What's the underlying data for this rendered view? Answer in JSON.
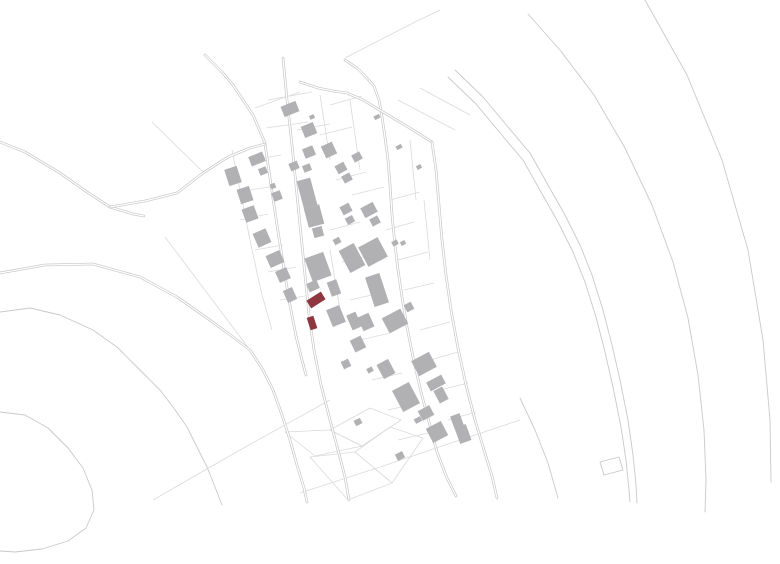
{
  "map": {
    "width": 780,
    "height": 564,
    "background": "#ffffff",
    "colors": {
      "building": "#b1b1b3",
      "building_dark": "#a4a4a6",
      "highlight": "#8e3741",
      "line": "#c9c9cc",
      "line_faint": "#dadadd",
      "road_casing": "#c3c3c6",
      "road_inner": "#ffffff"
    },
    "roads": [
      {
        "name": "north-approach",
        "points": "205,55 222,72 233,85 243,100 253,115 259,129 265,143"
      },
      {
        "name": "main-street",
        "points": "283,58 287,100 292,145 296,185 300,225 303,255 306,285 309,315 314,350 321,385 330,420 338,450 345,477 349,500"
      },
      {
        "name": "west-street",
        "points": "265,144 271,185 277,225 283,263 289,300 296,336 302,360 306,375"
      },
      {
        "name": "east-street",
        "points": "345,60 357,68 366,77 374,86 379,100 382,117 385,137 388,160 390,185 392,215 395,245 398,270 402,297 407,327 413,357 421,392 429,422 437,452 447,478 456,496"
      },
      {
        "name": "northeast-road",
        "points": "300,82 318,88 333,91 347,93 363,100 378,109 393,118 413,130 432,142"
      },
      {
        "name": "east-bypass",
        "points": "432,142 436,170 439,205 442,240 446,275 451,310 458,348 466,385 475,420 484,450 492,476 497,498"
      },
      {
        "name": "rural-southwest-road",
        "points": "0,273 45,265 93,264 140,277 177,297 207,318 233,337 250,350 263,370 273,390 282,415 290,440 297,465 304,488 307,502"
      },
      {
        "name": "west-lane-a",
        "points": "0,142 25,152 60,173 87,192 110,207 133,214 144,216"
      },
      {
        "name": "west-lane-b",
        "points": "110,207 145,201 177,193 203,173 228,157 250,148 265,144"
      }
    ],
    "paths": [
      {
        "name": "contour-lane-2",
        "points": "0,312 30,308 60,315 93,330 117,347 140,370 160,390 173,407 187,427 197,447 207,467 215,487 222,505"
      },
      {
        "name": "contour-hook",
        "points": "0,412 25,415 48,428 68,448 83,468 92,490 94,510 86,528 68,541 42,549 15,552 0,551"
      },
      {
        "name": "valley-curve-a",
        "points": "455,70 483,97 508,127 530,153 548,185 565,215 580,245 592,275 603,310 612,345 620,380 628,420 633,455 636,485 637,503"
      },
      {
        "name": "valley-curve-b",
        "points": "448,77 476,104 501,134 523,160 541,192 558,222 573,252 585,282 596,317 605,352 613,387 621,427 626,460 629,490 630,502"
      },
      {
        "name": "valley-curve-outer",
        "points": "528,14 560,50 594,95 625,148 652,205 673,262 688,318 698,375 704,430 706,480 705,512"
      },
      {
        "name": "valley-curve-far",
        "points": "645,0 687,75 722,160 748,250 763,340 770,420 771,482"
      },
      {
        "name": "south-fragment",
        "points": "520,398 535,430 548,463 558,498"
      }
    ],
    "faint_lines": [
      {
        "points": "165,237 250,350"
      },
      {
        "points": "152,122 203,172"
      },
      {
        "points": "153,500 240,450 330,400"
      },
      {
        "points": "300,493 380,467 460,440 520,420"
      },
      {
        "points": "345,58 380,40 415,22 440,10"
      },
      {
        "points": "398,100 455,130"
      },
      {
        "points": "420,88 470,115"
      },
      {
        "points": "255,108 277,100 300,92"
      },
      {
        "points": "232,150 242,200 252,250 262,295 272,330"
      },
      {
        "points": "268,100 312,92"
      },
      {
        "points": "266,128 308,122"
      },
      {
        "points": "252,160 281,155"
      },
      {
        "points": "297,130 330,124"
      },
      {
        "points": "250,190 276,186"
      },
      {
        "points": "240,220 268,214"
      },
      {
        "points": "255,250 283,245"
      },
      {
        "points": "268,272 296,267"
      },
      {
        "points": "280,300 305,296"
      },
      {
        "points": "330,105 362,96"
      },
      {
        "points": "320,135 352,127"
      },
      {
        "points": "336,180 366,172"
      },
      {
        "points": "352,195 384,187"
      },
      {
        "points": "330,230 360,222"
      },
      {
        "points": "342,262 372,255"
      },
      {
        "points": "390,200 420,192"
      },
      {
        "points": "386,230 414,222"
      },
      {
        "points": "398,260 428,252"
      },
      {
        "points": "404,290 434,283"
      },
      {
        "points": "350,300 380,293"
      },
      {
        "points": "360,340 390,333"
      },
      {
        "points": "372,380 402,373"
      },
      {
        "points": "388,410 418,403"
      },
      {
        "points": "398,440 428,433"
      },
      {
        "points": "420,330 450,322"
      },
      {
        "points": "430,360 458,352"
      },
      {
        "points": "440,390 468,383"
      },
      {
        "points": "448,420 476,412"
      },
      {
        "points": "320,95 330,160"
      },
      {
        "points": "350,100 360,170"
      },
      {
        "points": "410,140 416,200"
      },
      {
        "points": "424,200 430,260"
      },
      {
        "points": "330,250 340,310"
      }
    ],
    "parcel_polygons": [
      {
        "points": "355,452 390,427 423,438 392,483"
      },
      {
        "points": "310,457 355,452 392,483 348,500"
      },
      {
        "points": "330,430 370,408 401,420 362,446"
      },
      {
        "points": "285,432 330,430 362,446 315,456"
      }
    ],
    "outline_parcel": {
      "points": "600,462 619,457 623,470 604,475"
    },
    "buildings": [
      {
        "x": 290,
        "y": 109,
        "w": 16,
        "h": 11,
        "r": -22
      },
      {
        "x": 309,
        "y": 130,
        "w": 13,
        "h": 12,
        "r": -22
      },
      {
        "x": 312,
        "y": 117,
        "w": 5,
        "h": 4,
        "r": -22
      },
      {
        "x": 309,
        "y": 152,
        "w": 11,
        "h": 10,
        "r": -22
      },
      {
        "x": 329,
        "y": 150,
        "w": 12,
        "h": 13,
        "r": -25
      },
      {
        "x": 357,
        "y": 157,
        "w": 9,
        "h": 8,
        "r": -28
      },
      {
        "x": 257,
        "y": 159,
        "w": 15,
        "h": 10,
        "r": -22
      },
      {
        "x": 263,
        "y": 171,
        "w": 8,
        "h": 7,
        "r": -22
      },
      {
        "x": 294,
        "y": 166,
        "w": 9,
        "h": 8,
        "r": -22
      },
      {
        "x": 307,
        "y": 168,
        "w": 8,
        "h": 7,
        "r": -22
      },
      {
        "x": 341,
        "y": 168,
        "w": 10,
        "h": 9,
        "r": -28
      },
      {
        "x": 347,
        "y": 178,
        "w": 9,
        "h": 8,
        "r": -28
      },
      {
        "x": 377,
        "y": 117,
        "w": 6,
        "h": 4,
        "r": -28
      },
      {
        "x": 399,
        "y": 147,
        "w": 6,
        "h": 4,
        "r": -28
      },
      {
        "x": 419,
        "y": 167,
        "w": 5,
        "h": 4,
        "r": -28
      },
      {
        "x": 233,
        "y": 176,
        "w": 13,
        "h": 17,
        "r": -18
      },
      {
        "x": 245,
        "y": 195,
        "w": 13,
        "h": 15,
        "r": -18
      },
      {
        "x": 273,
        "y": 186,
        "w": 5,
        "h": 5,
        "r": -20
      },
      {
        "x": 277,
        "y": 196,
        "w": 9,
        "h": 9,
        "r": -20
      },
      {
        "x": 250,
        "y": 214,
        "w": 13,
        "h": 14,
        "r": -20
      },
      {
        "x": 262,
        "y": 238,
        "w": 14,
        "h": 15,
        "r": -24
      },
      {
        "x": 275,
        "y": 259,
        "w": 15,
        "h": 13,
        "r": -24
      },
      {
        "x": 283,
        "y": 275,
        "w": 12,
        "h": 12,
        "r": -24
      },
      {
        "x": 290,
        "y": 295,
        "w": 10,
        "h": 13,
        "r": -24
      },
      {
        "x": 307,
        "y": 193,
        "w": 14,
        "h": 28,
        "r": -15
      },
      {
        "x": 314,
        "y": 216,
        "w": 16,
        "h": 20,
        "r": -15
      },
      {
        "x": 318,
        "y": 232,
        "w": 10,
        "h": 10,
        "r": -15
      },
      {
        "x": 346,
        "y": 209,
        "w": 10,
        "h": 9,
        "r": -28
      },
      {
        "x": 350,
        "y": 220,
        "w": 8,
        "h": 7,
        "r": -28
      },
      {
        "x": 369,
        "y": 210,
        "w": 14,
        "h": 11,
        "r": -28
      },
      {
        "x": 375,
        "y": 221,
        "w": 9,
        "h": 8,
        "r": -28
      },
      {
        "x": 337,
        "y": 241,
        "w": 7,
        "h": 6,
        "r": -28
      },
      {
        "x": 395,
        "y": 243,
        "w": 6,
        "h": 5,
        "r": -28
      },
      {
        "x": 403,
        "y": 243,
        "w": 5,
        "h": 4,
        "r": -28
      },
      {
        "x": 318,
        "y": 267,
        "w": 20,
        "h": 25,
        "r": -20
      },
      {
        "x": 313,
        "y": 286,
        "w": 11,
        "h": 9,
        "r": -24
      },
      {
        "x": 352,
        "y": 258,
        "w": 17,
        "h": 25,
        "r": -28
      },
      {
        "x": 373,
        "y": 252,
        "w": 22,
        "h": 22,
        "r": -28
      },
      {
        "x": 377,
        "y": 290,
        "w": 15,
        "h": 31,
        "r": -18
      },
      {
        "x": 395,
        "y": 321,
        "w": 21,
        "h": 17,
        "r": -28
      },
      {
        "x": 409,
        "y": 307,
        "w": 8,
        "h": 8,
        "r": -28
      },
      {
        "x": 366,
        "y": 322,
        "w": 12,
        "h": 15,
        "r": -24
      },
      {
        "x": 336,
        "y": 316,
        "w": 14,
        "h": 18,
        "r": -22
      },
      {
        "x": 334,
        "y": 288,
        "w": 10,
        "h": 15,
        "r": -20
      },
      {
        "x": 354,
        "y": 321,
        "w": 10,
        "h": 16,
        "r": -24
      },
      {
        "x": 358,
        "y": 344,
        "w": 12,
        "h": 13,
        "r": -26
      },
      {
        "x": 346,
        "y": 364,
        "w": 8,
        "h": 8,
        "r": -26
      },
      {
        "x": 386,
        "y": 369,
        "w": 13,
        "h": 16,
        "r": -28
      },
      {
        "x": 370,
        "y": 370,
        "w": 6,
        "h": 5,
        "r": -28
      },
      {
        "x": 424,
        "y": 364,
        "w": 20,
        "h": 17,
        "r": -28
      },
      {
        "x": 436,
        "y": 383,
        "w": 17,
        "h": 10,
        "r": -28
      },
      {
        "x": 441,
        "y": 395,
        "w": 10,
        "h": 14,
        "r": -28
      },
      {
        "x": 406,
        "y": 397,
        "w": 19,
        "h": 24,
        "r": -28
      },
      {
        "x": 426,
        "y": 413,
        "w": 13,
        "h": 11,
        "r": -28
      },
      {
        "x": 437,
        "y": 432,
        "w": 17,
        "h": 16,
        "r": -28
      },
      {
        "x": 457,
        "y": 421,
        "w": 10,
        "h": 13,
        "r": -20
      },
      {
        "x": 463,
        "y": 434,
        "w": 12,
        "h": 17,
        "r": -20
      },
      {
        "x": 400,
        "y": 456,
        "w": 8,
        "h": 7,
        "r": -28
      },
      {
        "x": 418,
        "y": 420,
        "w": 7,
        "h": 5,
        "r": -28
      },
      {
        "x": 358,
        "y": 422,
        "w": 7,
        "h": 6,
        "r": -28
      }
    ],
    "highlighted_buildings": [
      {
        "x": 316,
        "y": 300,
        "w": 17,
        "h": 9,
        "r": -32
      },
      {
        "x": 312,
        "y": 323,
        "w": 7,
        "h": 13,
        "r": -18
      }
    ]
  }
}
